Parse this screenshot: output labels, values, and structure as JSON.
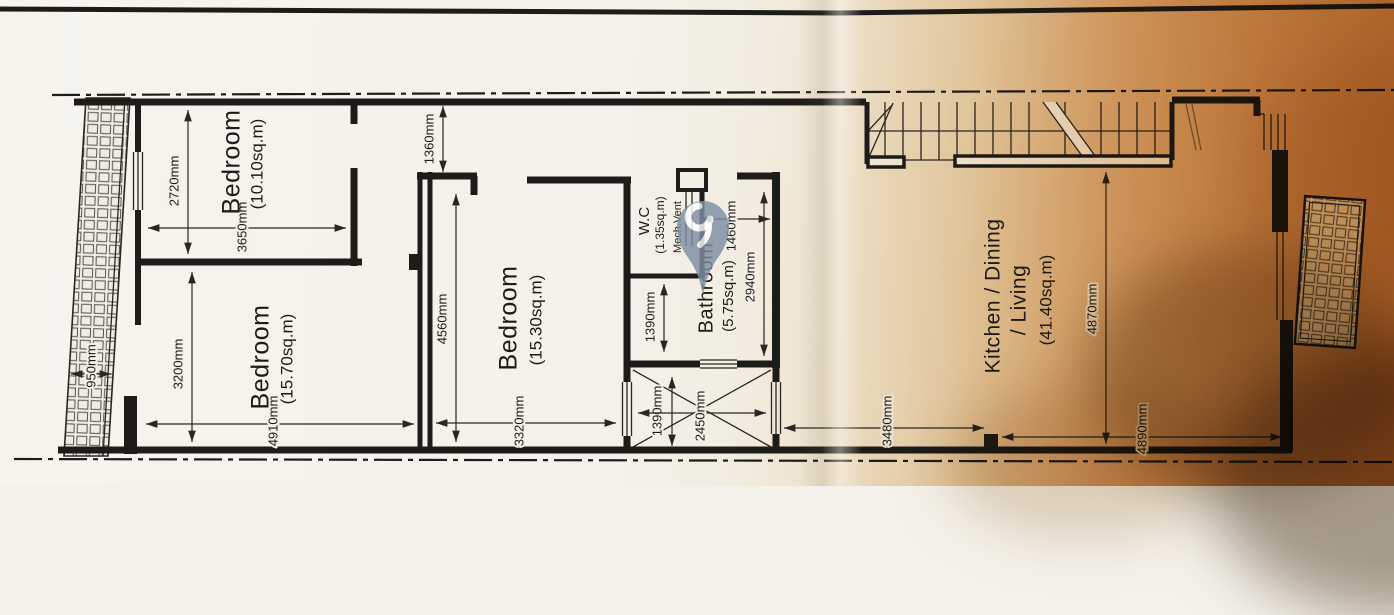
{
  "plan": {
    "rooms": {
      "bedroom1": {
        "name": "Bedroom",
        "area": "(10.10sq.m)"
      },
      "bedroom2": {
        "name": "Bedroom",
        "area": "(15.70sq.m)"
      },
      "bedroom3": {
        "name": "Bedroom",
        "area": "(15.30sq.m)"
      },
      "wc": {
        "name": "W.C",
        "area": "(1.35sq.m)",
        "vent": "Mech.Vent"
      },
      "bathroom": {
        "name": "Bathroom",
        "area": "(5.75sq.m)"
      },
      "kitchen": {
        "name": "Kitchen / Dining",
        "name2": "/ Living",
        "area": "(41.40sq.m)"
      }
    },
    "dims": {
      "balcony_width": "950mm",
      "bed1_height": "2720mm",
      "bed1_width": "3650mm",
      "bed2_height": "3200mm",
      "bed2_width": "4910mm",
      "bed3_offset": "1360mm",
      "bed3_height": "4560mm",
      "bed3_width": "3320mm",
      "wc_width": "1460mm",
      "bath_height": "2940mm",
      "bath_depth": "1390mm",
      "shaft_height": "1390mm",
      "shaft_width": "2450mm",
      "kitchen_height": "4870mm",
      "kitchen_left_width": "3480mm",
      "kitchen_right_width": "4890mm"
    },
    "colors": {
      "ink": "#1e1c19",
      "paper": "#f4f1ea",
      "warm_cast": "#cc9558",
      "watermark": "#7d8ea3"
    }
  }
}
